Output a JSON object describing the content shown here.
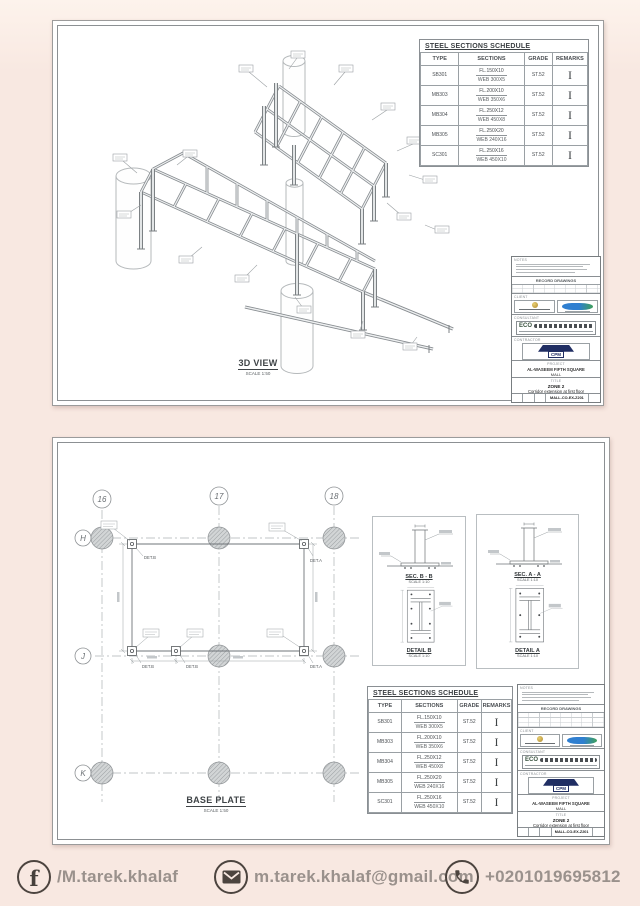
{
  "sheet1": {
    "view_label": "3D VIEW",
    "view_scale": "SCALE 1:50"
  },
  "sheet2": {
    "plan_label": "BASE PLATE",
    "plan_scale": "SCALE 1:50",
    "grid_cols": [
      "16",
      "17",
      "18"
    ],
    "grid_rows": [
      "H",
      "J",
      "K"
    ],
    "det_a": "DET.A",
    "det_b": "DET.B",
    "details": [
      {
        "sec_label": "SEC. B - B",
        "sec_scale": "SCALE 1:10",
        "det_label": "DETAIL B",
        "det_scale": "SCALE 1:10"
      },
      {
        "sec_label": "SEC. A - A",
        "sec_scale": "SCALE 1:10",
        "det_label": "DETAIL A",
        "det_scale": "SCALE 1:10"
      }
    ]
  },
  "schedule": {
    "title": "STEEL SECTIONS SCHEDULE",
    "headers": [
      "TYPE",
      "SECTIONS",
      "GRADE",
      "REMARKS"
    ],
    "rows": [
      {
        "type": "SB301",
        "fl": "FL.150X10",
        "web": "WEB  300X5",
        "grade": "ST.52",
        "remark": "I"
      },
      {
        "type": "MB303",
        "fl": "FL.200X10",
        "web": "WEB  350X6",
        "grade": "ST.52",
        "remark": "I"
      },
      {
        "type": "MB304",
        "fl": "FL.250X12",
        "web": "WEB  450X8",
        "grade": "ST.52",
        "remark": "I"
      },
      {
        "type": "MB305",
        "fl": "FL.250X20",
        "web": "WEB  240X16",
        "grade": "ST.52",
        "remark": "I"
      },
      {
        "type": "SC301",
        "fl": "FL.250X16",
        "web": "WEB  450X10",
        "grade": "ST.52",
        "remark": "I"
      }
    ]
  },
  "titleblock": {
    "notes_label": "NOTES",
    "record_label": "RECORD DRAWINGS",
    "client_label": "CLIENT",
    "consultant_label": "CONSULTANT",
    "contractor_label": "CONTRACTOR",
    "eco_text": "ECO",
    "cpm_text": "CPM",
    "project_label": "PROJECT",
    "project_line1": "AL-WASEEM FIFTH SQUARE",
    "project_line2": "MALL",
    "title_label": "TITLE",
    "zone_text": "ZONE 2",
    "title_text": "Corridor extension at first floor",
    "dwg_no": "MALL-CO-EX-Z201"
  },
  "footer": {
    "facebook_handle": "/M.tarek.khalaf",
    "email": "m.tarek.khalaf@gmail.com",
    "phone": "+0201019695812"
  },
  "colors": {
    "background": "#f8e8e1",
    "icon": "#4c443f",
    "text_gray": "#9a918c",
    "cpm_navy": "#202e63"
  }
}
